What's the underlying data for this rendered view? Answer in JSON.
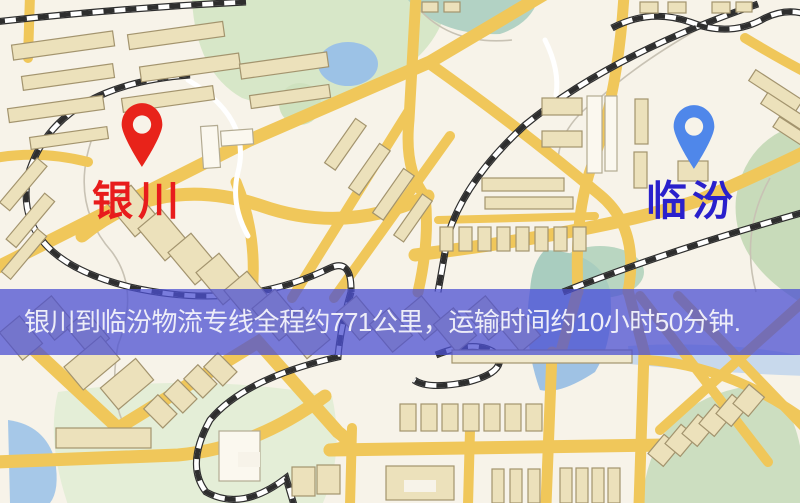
{
  "page": {
    "width": 800,
    "height": 503,
    "kind": "logistics-route-map"
  },
  "banner": {
    "text": "银川到临汾物流专线全程约771公里，运输时间约10小时50分钟.",
    "distance": "771公里",
    "duration": "10小时50分钟",
    "background_color": "rgba(76,80,210,0.75)",
    "text_color": "#ededf8"
  },
  "origin": {
    "name": "银川",
    "pin_color": "#e8231a",
    "label_color": "#e81c1c"
  },
  "destination": {
    "name": "临汾",
    "pin_color": "#4f87ea",
    "label_color": "#2a20cc"
  },
  "map_palette": {
    "background": "#f7f3e9",
    "road_yellow": "#f0c75a",
    "road_white": "#ffffff",
    "park_green": "#d7e7c8",
    "water_blue": "#9fc2e4",
    "building_tan": "#ece1bb",
    "railway_dark": "#2e2e2e"
  }
}
